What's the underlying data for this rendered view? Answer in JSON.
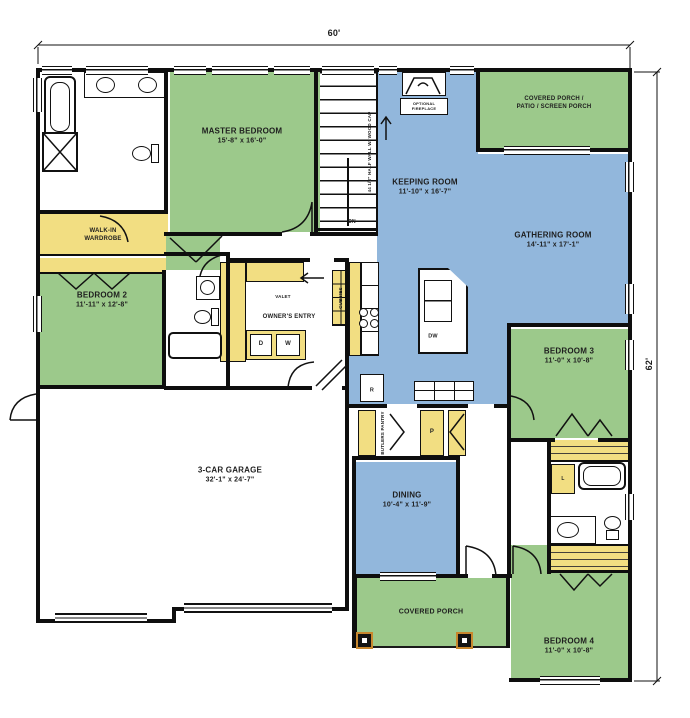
{
  "dimensions": {
    "width": "60'",
    "height": "62'"
  },
  "rooms": {
    "master_bedroom": {
      "name": "MASTER BEDROOM",
      "dims": "15'-8\" x 16'-0\""
    },
    "walk_in_wardrobe": {
      "line1": "WALK-IN",
      "line2": "WARDROBE"
    },
    "bedroom_2": {
      "name": "BEDROOM 2",
      "dims": "11'-11\" x 12'-8\""
    },
    "keeping_room": {
      "name": "KEEPING ROOM",
      "dims": "11'-10\" x 16'-7\""
    },
    "gathering_room": {
      "name": "GATHERING ROOM",
      "dims": "14'-11\" x 17'-1\""
    },
    "covered_porch_patio": {
      "line1": "COVERED PORCH /",
      "line2": "PATIO / SCREEN PORCH"
    },
    "bedroom_3": {
      "name": "BEDROOM 3",
      "dims": "11'-0\" x 10'-8\""
    },
    "bedroom_4": {
      "name": "BEDROOM 4",
      "dims": "11'-0\" x 10'-8\""
    },
    "dining": {
      "name": "DINING",
      "dims": "10'-4\" x 11'-9\""
    },
    "covered_porch": {
      "name": "COVERED PORCH"
    },
    "garage": {
      "name": "3-CAR GARAGE",
      "dims": "32'-1\" x 24'-7\""
    },
    "owners_entry": {
      "name": "OWNER'S ENTRY"
    }
  },
  "labels": {
    "optional_fireplace_1": "OPTIONAL",
    "optional_fireplace_2": "FIREPLACE",
    "half_wall": "44 1/2\" HALF WALL W/ WOOD CAP",
    "down": "DN",
    "valet": "VALET",
    "cubbies": "CUBBIES",
    "butlers_pantry": "BUTLERS PANTRY",
    "dryer": "D",
    "washer": "W",
    "pantry": "P",
    "refrigerator": "R",
    "dishwasher": "DW",
    "linen": "L"
  },
  "colors": {
    "bedroom_green": "#9cc98b",
    "living_blue": "#92b7dc",
    "storage_yellow": "#f2de82",
    "wall_black": "#0e0e0e",
    "column_accent": "#c8872e"
  }
}
